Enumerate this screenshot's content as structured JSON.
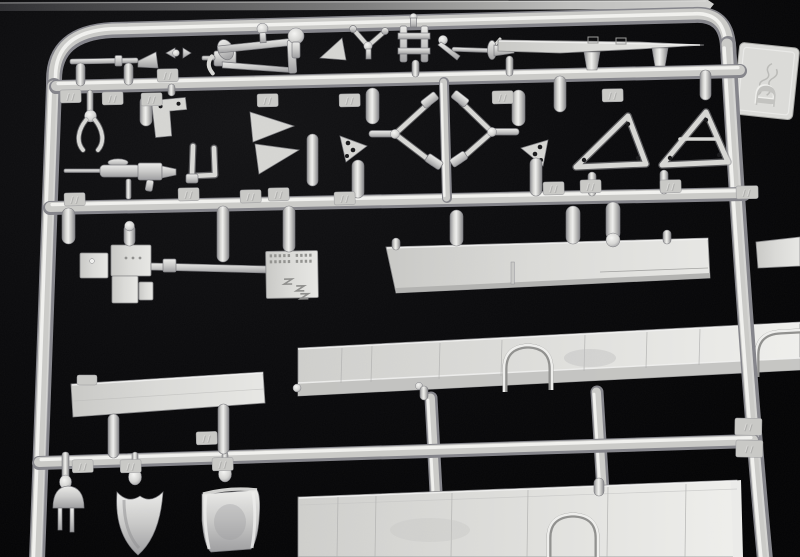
{
  "scene": {
    "title": "Model kit sprue D — grey injection-moulded parts on black",
    "subject": "Photograph of a light-grey polystyrene model aircraft kit sprue (parts tree) laid on a black background, cropped at the bottom edge",
    "background_color": "#060607",
    "plastic_color": "#d2d2cf",
    "plastic_highlight": "#f2f2f0",
    "plastic_shadow": "#7e7e82",
    "panel_color": "#dcdcd9"
  },
  "sprue": {
    "tag_letter": "D",
    "tag_logo": "embossed cursive manufacturer script (illegible)",
    "part_number_tabs": "small embossed two-digit part numbers on moulded tabs, too small to be legible",
    "runners": [
      "outer rounded frame",
      "top cross runner",
      "middle cross runner",
      "bottom cross runner",
      "three short vertical connector runners"
    ]
  },
  "parts": [
    {
      "name": "neighboring-sprue-edge",
      "description": "thin edge of another sprue visible along the very top of the photo"
    },
    {
      "name": "logo-tab",
      "description": "flat tab on the right frame rail embossed with a cursive logo and the sprue letter D"
    },
    {
      "name": "gun-barrel-with-muzzle",
      "description": "thin rod with conical muzzle, top left"
    },
    {
      "name": "rocker-bracket-frame",
      "description": "small open rectangular bracket with lever and ball pin"
    },
    {
      "name": "mushroom-pin",
      "description": "round-headed pin"
    },
    {
      "name": "wedge-plate",
      "description": "small triangular wedge"
    },
    {
      "name": "control-yoke",
      "description": "small forked yoke with ball centre"
    },
    {
      "name": "h-frame-bracket",
      "description": "ladder-like H frame"
    },
    {
      "name": "lever-and-arm",
      "description": "small lever with ball end and thin arm"
    },
    {
      "name": "venturi-horn",
      "description": "tiny trumpet-shaped venturi"
    },
    {
      "name": "tapered-strut-blade",
      "description": "long tapered flat blade along the top right"
    },
    {
      "name": "grab-claw",
      "description": "two-pronged claw on a stem"
    },
    {
      "name": "l-bracket-plate",
      "description": "flat L-shaped plate with holes"
    },
    {
      "name": "u-channel-bracket",
      "description": "square U-shaped bracket"
    },
    {
      "name": "wedge-fins",
      "description": "pair of small triangular fins"
    },
    {
      "name": "lewis-machine-gun",
      "description": "small machine gun with jacketed barrel"
    },
    {
      "name": "vee-struts",
      "description": "mirrored pair of V-shaped undercarriage struts with drilled hinge plates"
    },
    {
      "name": "a-frame-struts",
      "description": "two triangular A-frame struts with lightening holes"
    },
    {
      "name": "heavy-machine-gun",
      "description": "large machine gun body with square plates and long barrel"
    },
    {
      "name": "riveted-detail-plate",
      "description": "flat plate with rows of rivets and three Z-shaped marks"
    },
    {
      "name": "walkway-strip-panel",
      "description": "long narrow flat strip panel, centre"
    },
    {
      "name": "fuselage-panel-upper",
      "description": "long fuselage side panel with panel lines and two wheel-arch bulges"
    },
    {
      "name": "hatch-lid-panel",
      "description": "small rectangular hatch lid, lower left"
    },
    {
      "name": "fuselage-panel-lower",
      "description": "second long fuselage panel with panel lines and a wheel arch, cropped by bottom edge"
    },
    {
      "name": "headrest-plug",
      "description": "dome-shaped plug with two pins"
    },
    {
      "name": "intake-scoop",
      "description": "curved scoop / seat pan on ball stem"
    },
    {
      "name": "bucket-seat",
      "description": "square bucket seat with rolled edges on ball stem"
    },
    {
      "name": "sprue-gates",
      "description": "many sausage-shaped moulding gates joining parts to runners"
    }
  ]
}
